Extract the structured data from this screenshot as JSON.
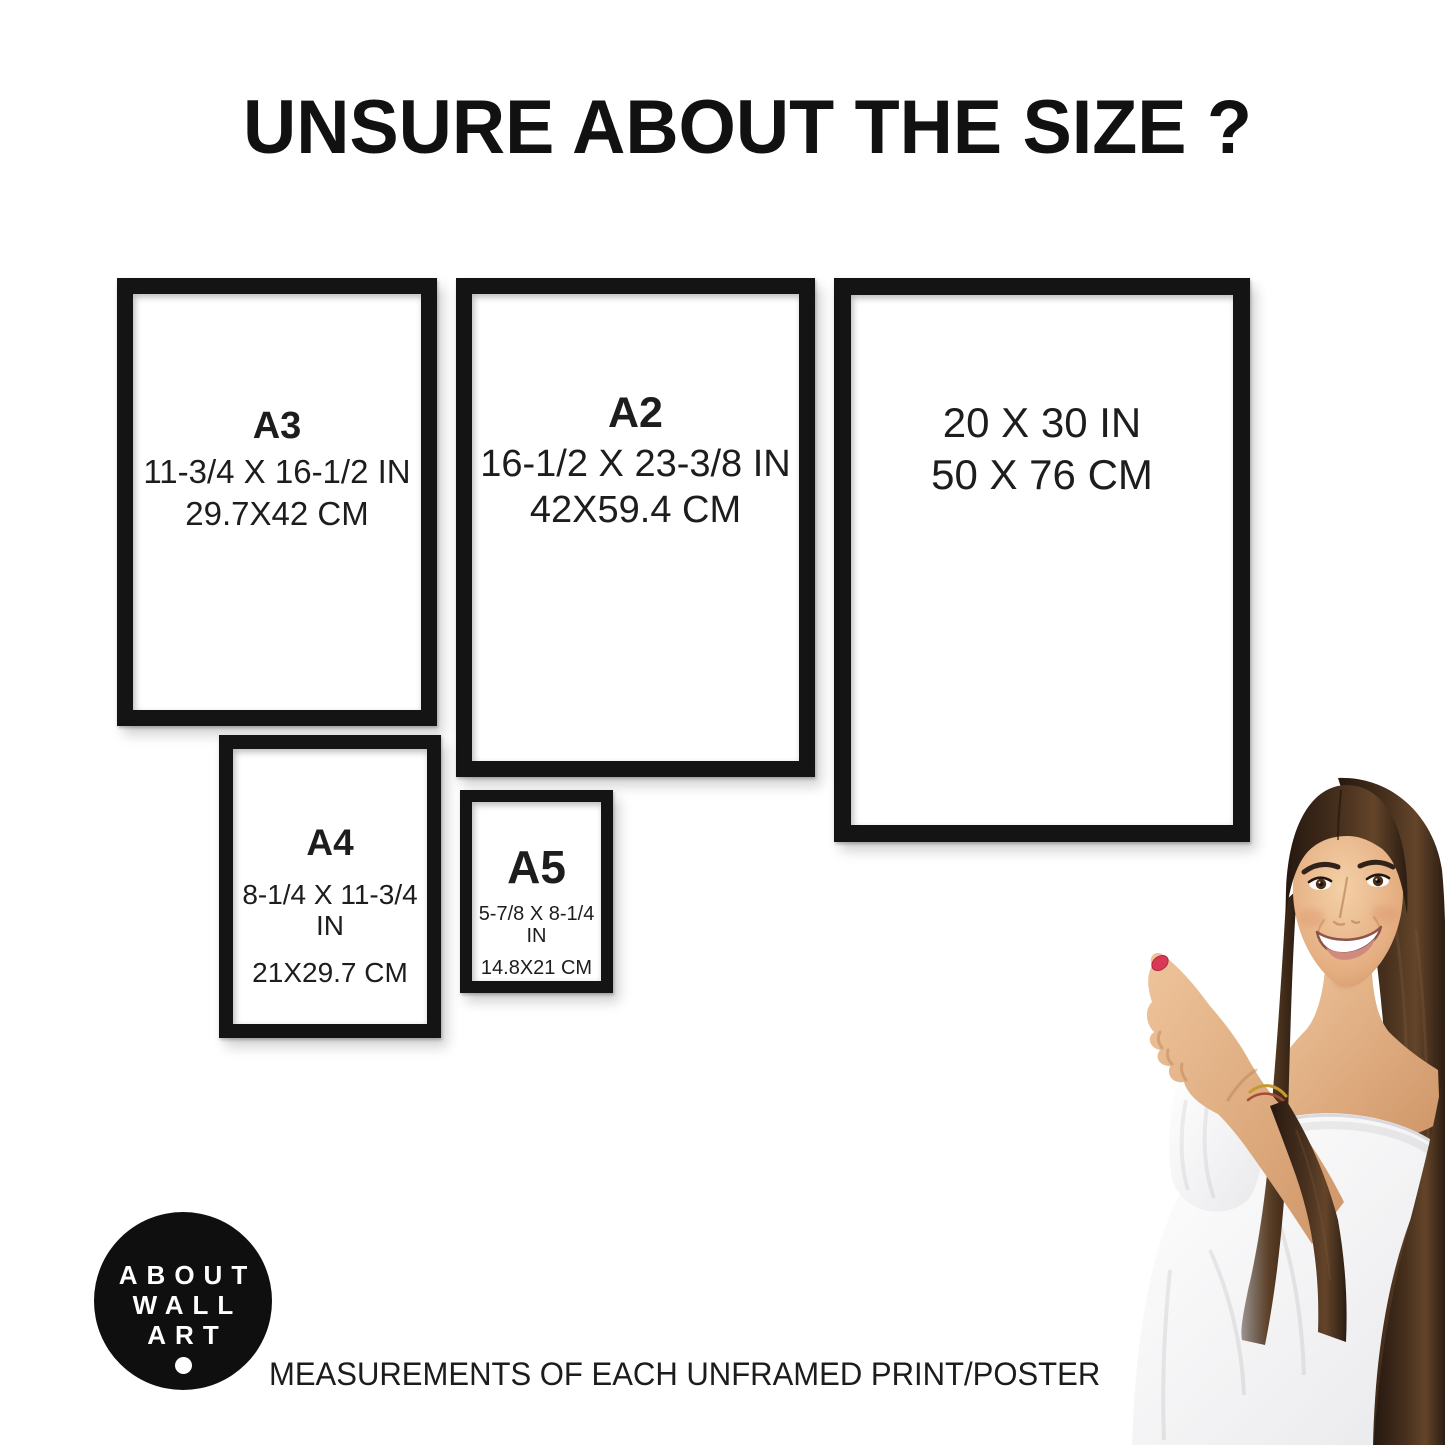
{
  "page": {
    "title": "UNSURE ABOUT THE SIZE ?",
    "caption": "MEASUREMENTS OF EACH UNFRAMED PRINT/POSTER",
    "background_color": "#ffffff",
    "text_color": "#111111",
    "frame_color": "#141414"
  },
  "frames": [
    {
      "id": "a3",
      "label": "A3",
      "line1": "11-3/4 X 16-1/2 IN",
      "line2": "29.7X42 CM"
    },
    {
      "id": "a2",
      "label": "A2",
      "line1": "16-1/2 X 23-3/8 IN",
      "line2": "42X59.4 CM"
    },
    {
      "id": "p2030",
      "label": "",
      "line1": "20 X 30 IN",
      "line2": "50 X 76 CM"
    },
    {
      "id": "a4",
      "label": "A4",
      "line1": "8-1/4 X 11-3/4 IN",
      "line2": "21X29.7 CM"
    },
    {
      "id": "a5",
      "label": "A5",
      "line1": "5-7/8 X 8-1/4 IN",
      "line2": "14.8X21 CM"
    }
  ],
  "logo": {
    "lines": [
      "ABOUT",
      "WALL",
      "ART"
    ],
    "background": "#0f0f0f",
    "foreground": "#ffffff"
  },
  "photo": {
    "subject": "woman-pointing-at-frames",
    "hair_color": "#3f2c1c",
    "skin_color": "#e0a97e",
    "blouse_color": "#fbfbfc",
    "nail_color": "#d63a57",
    "bracelet_color": "#c59a2e"
  }
}
